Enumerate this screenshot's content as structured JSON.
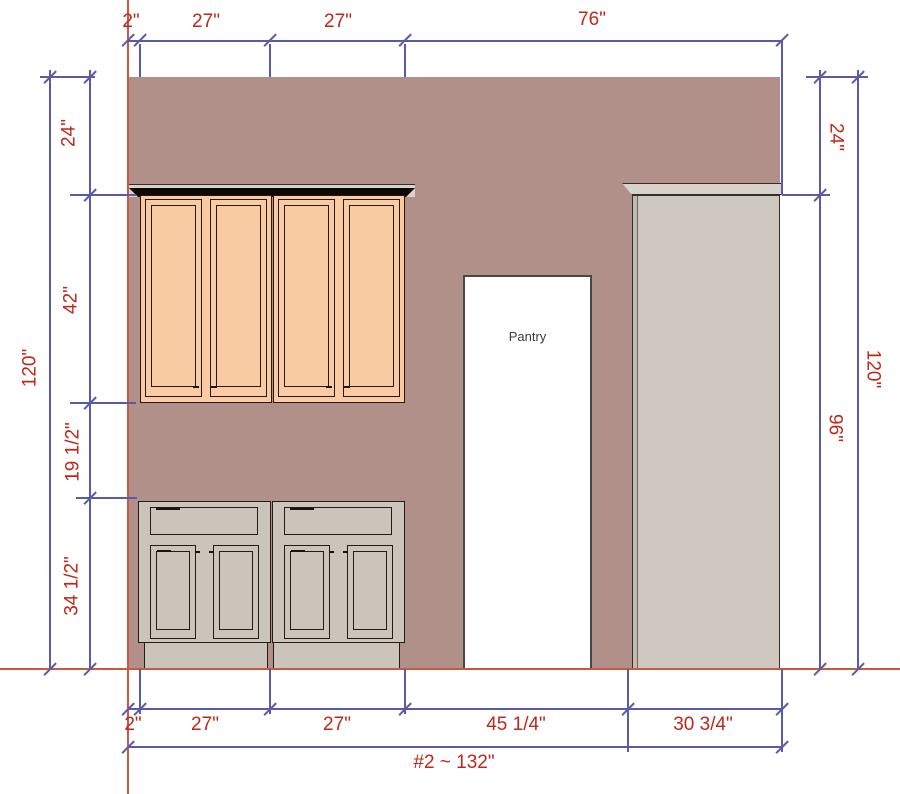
{
  "drawing": {
    "pantry_label": "Pantry",
    "wall_overall_label": "#2 ~ 132\""
  },
  "dims": {
    "top": {
      "d2": "2\"",
      "d27a": "27\"",
      "d27b": "27\"",
      "d76": "76\""
    },
    "left": {
      "d24": "24\"",
      "d42": "42\"",
      "d19": "19 1/2\"",
      "d34": "34 1/2\"",
      "d120": "120\""
    },
    "right": {
      "d24": "24\"",
      "d96": "96\"",
      "d120": "120\""
    },
    "bottom": {
      "d2": "2\"",
      "d27a": "27\"",
      "d27b": "27\"",
      "d45": "45 1/4\"",
      "d30": "30 3/4\""
    }
  },
  "colors": {
    "wall": "#b1908a",
    "upper_cabinet": "#f8cba3",
    "base_cabinet": "#cbc4bb",
    "tall_cabinet": "#cfc8c0",
    "dimension_line": "#5a5aa8",
    "dimension_text": "#c0261a",
    "reference_line": "#cb5844",
    "pantry_fill": "#ffffff"
  }
}
